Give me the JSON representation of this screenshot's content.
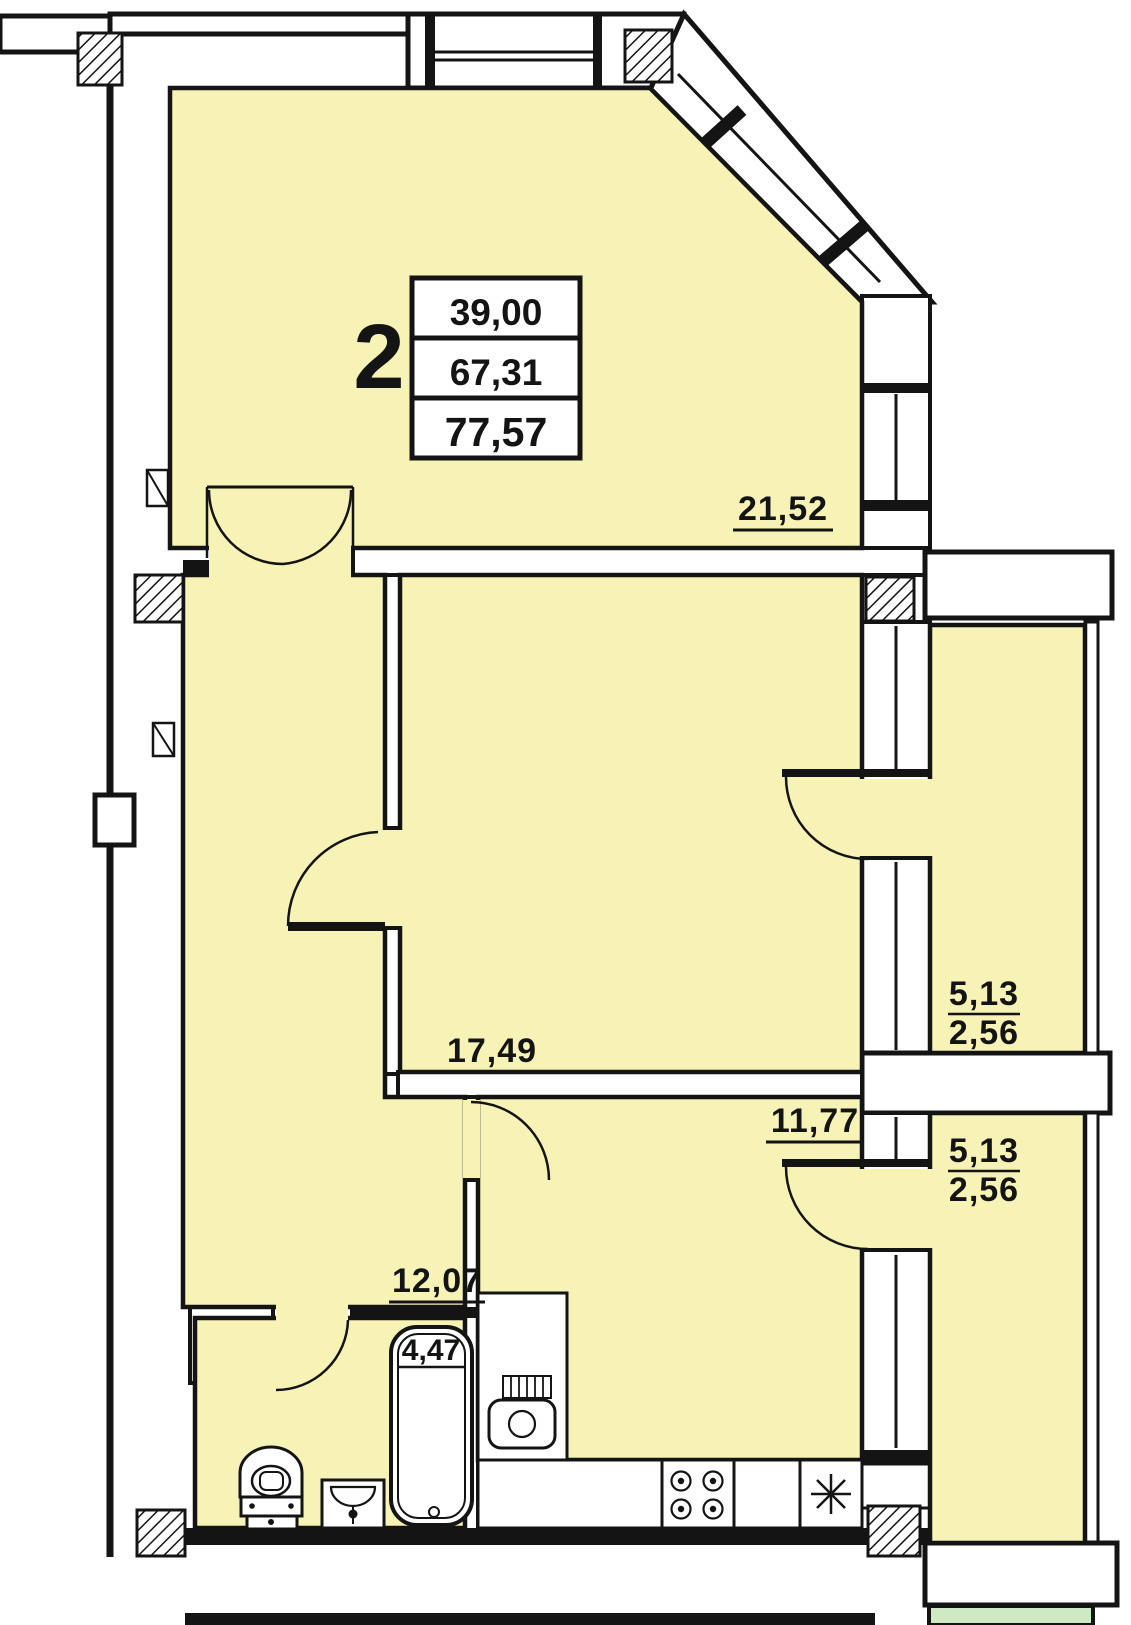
{
  "plan_title": "apartment-2-floor-plan",
  "unit": {
    "number": "2",
    "info_table": {
      "living_area": "39,00",
      "apartment_area": "67,31",
      "total_area": "77,57"
    }
  },
  "rooms": {
    "living": {
      "area": "21,52"
    },
    "bedroom": {
      "area": "17,49"
    },
    "kitchen": {
      "area": "11,77"
    },
    "hallway": {
      "area": "12,07"
    },
    "bathroom": {
      "area": "4,47"
    },
    "balcony_upper": {
      "area_full": "5,13",
      "area_counted": "2,56"
    },
    "balcony_lower": {
      "area_full": "5,13",
      "area_counted": "2,56"
    }
  },
  "colors": {
    "room_fill": "#f7f2b5",
    "neighbor_fill": "#cfe9c5",
    "wall": "#141414",
    "paper": "#ffffff"
  }
}
